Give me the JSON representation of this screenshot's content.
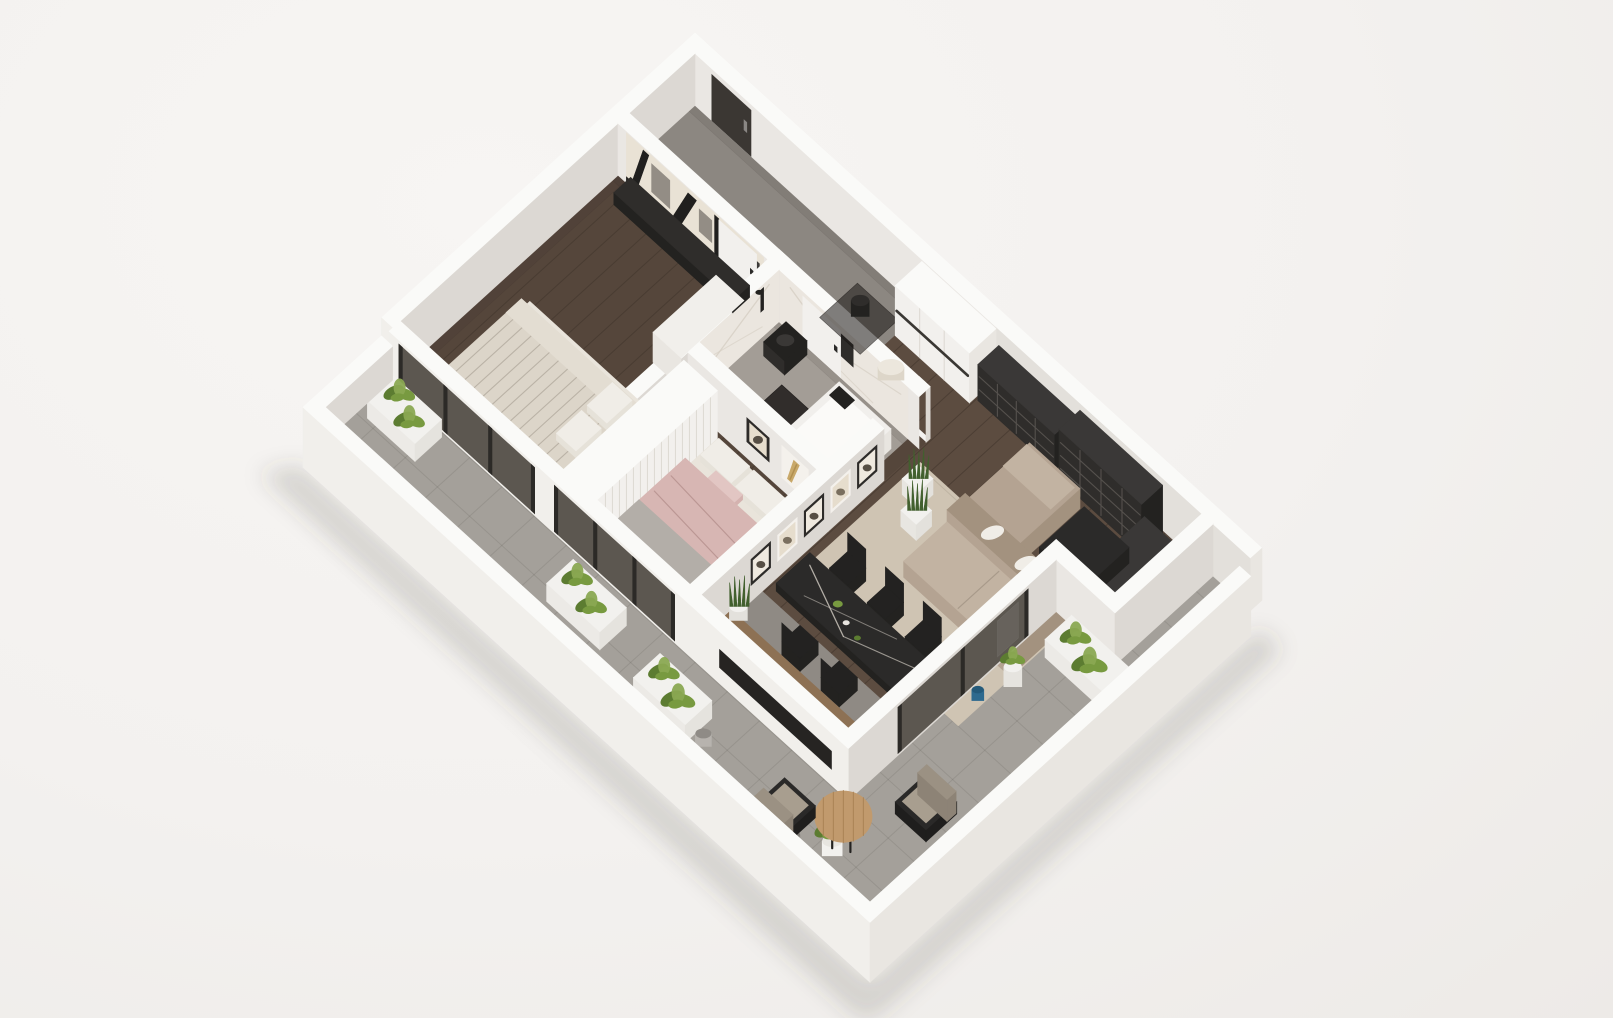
{
  "title": "3D isometric floor plan render of a two-bedroom apartment with wrap-around terrace",
  "scene": {
    "type": "isometric-floorplan-render",
    "style": "dollhouse cutaway, walls cut at uniform height, no text or labels visible"
  },
  "rooms": [
    {
      "name": "entrance-hall",
      "floor": "gray tile",
      "items": [
        "front-door",
        "black-stool",
        "dark-mat",
        "white-closet",
        "pouf"
      ]
    },
    {
      "name": "bedroom-1",
      "floor": "dark wood",
      "items": [
        "abstract-art-wall",
        "media-console",
        "white-dresser",
        "double-bed-striped",
        "terrace-glass-door"
      ]
    },
    {
      "name": "bathroom",
      "floor": "gray tile",
      "items": [
        "marble-walls",
        "black-toilet",
        "bathtub",
        "black-shower",
        "black-mirror",
        "black-mat"
      ]
    },
    {
      "name": "bedroom-2",
      "floor": "dark wood",
      "items": [
        "slatted-wardrobe",
        "double-bed-pink",
        "bench",
        "gold-artwork",
        "rug",
        "terrace-glass-door"
      ]
    },
    {
      "name": "living-room",
      "floor": "dark wood",
      "items": [
        "bookshelf-low",
        "bookshelf-tall",
        "bookshelf-corner",
        "gallery-frames",
        "snake-plants",
        "sofa-l-shaped",
        "coffee-table",
        "rug"
      ]
    },
    {
      "name": "kitchen-dining",
      "floor": "gray tile strip",
      "items": [
        "wood-counter",
        "black-marble-dining-table",
        "five-black-chairs",
        "snake-plant"
      ]
    },
    {
      "name": "terrace",
      "floor": "gray pavers",
      "items": [
        "fern-planters",
        "steel-pot",
        "round-wood-table",
        "two-outdoor-armchairs",
        "plant-stand",
        "blue-vase"
      ]
    }
  ],
  "palette": {
    "bg": "#f3f1ef",
    "bgLight": "#f7f5f3",
    "bgEdge": "#edeae7",
    "shadow": "rgba(80,68,58,0.18)",
    "wallTop": "#fafaf8",
    "faceL": "#eae7e3",
    "faceL2": "#e3e0db",
    "faceR": "#dcd8d3",
    "white": "#f1efeb",
    "white2": "#efede9",
    "slabSide": "#e9e6e1",
    "woodDark": "#55463b",
    "woodLine": "rgba(30,22,16,0.35)",
    "woodLiving": "#5c4c40",
    "tileHall": "#8c8781",
    "tileBath": "#a39d96",
    "tileKitchen": "#8f8a84",
    "terrace": "#a4a09a",
    "terraceLine": "rgba(60,56,50,0.12)",
    "dark": "#2f2d2b",
    "darker": "#232220",
    "shelfLine": "#55514d",
    "marble": "#ebe6df",
    "marbleVein": "#d6cfc4",
    "doorDark": "#3b3733",
    "doorWhite": "#f2f0ed",
    "handle": "#8a8784",
    "handleDark": "#2b2a28",
    "glass": "#5c5750",
    "glassFrame": "#2c2a27",
    "sofa": "#b4a392",
    "sofaLight": "#c2b3a2",
    "sofaDark": "#a3927f",
    "rug": "#cfc4b3",
    "rug2": "#c1b9af",
    "bedBase": "#e9e4db",
    "bed1": "#dcd5c9",
    "bed1Side": "#d2cabd",
    "stripe": "rgba(110,100,85,0.30)",
    "pillow": "#f0ede7",
    "pink": "#d7b6b3",
    "pinkSide": "#cbaaa7",
    "pinkLight": "#e2c6c3",
    "grayThrow": "#b3aea8",
    "benchWood": "#8a7358",
    "counterWood": "#8d7154",
    "counterSide": "#6e5740",
    "tableBlack": "#2b2a29",
    "vein": "#cac4bb",
    "chair": "#232221",
    "plant": "#789a40",
    "plantDark": "#5c7c31",
    "plantLight": "#8aa852",
    "snake": "#42602e",
    "planter": "#f2f1ee",
    "potSteel": "#b7b3ae",
    "potGray": "#8f8b86",
    "gold": "#c8a869",
    "blue": "#2e6a8e",
    "woodTable": "#c19a6d",
    "woodTableLine": "#a98254",
    "outChair": "#a89e8f",
    "outChairBack": "#9b9183",
    "outChairFrame": "#2a2928",
    "artBase": "#e9e2d5",
    "artDark": "#201f1e",
    "artGray": "#938d85",
    "frameDark": "#2d2b29",
    "frameInnerLight": "#efe9df",
    "frameWhite": "#f4f1ec",
    "frameInnerTan": "#e6ddcd",
    "motif": "#564e44",
    "tubFront": "#302e2c",
    "tubSide": "#e8e5e0",
    "tubTop": "#f1efec",
    "bowl": "#fbfaf8",
    "matBlack": "rgba(20,18,16,0.80)",
    "railDark": "#3a3733",
    "ao": "rgba(50,42,36,0.10)"
  }
}
